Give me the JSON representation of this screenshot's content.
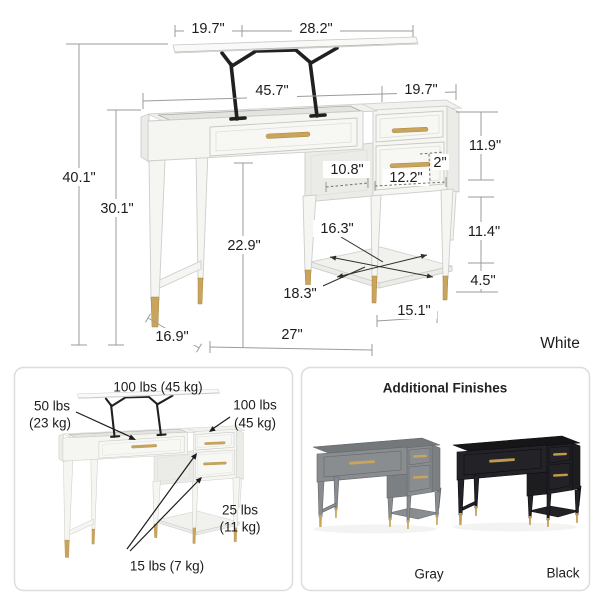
{
  "diagram": {
    "finish_label": "White",
    "dims": {
      "lift_left": "19.7\"",
      "lift_right": "28.2\"",
      "width_main": "45.7\"",
      "width_side": "19.7\"",
      "height_total": "40.1\"",
      "height_desk": "30.1\"",
      "clearance": "22.9\"",
      "drawer_section_height": "11.9\"",
      "side_opening_depth": "10.8\"",
      "drawer_face": "2\"",
      "side_opening_width": "12.2\"",
      "shelf_depth": "16.3\"",
      "leg_height": "11.4\"",
      "foot_height": "4.5\"",
      "shelf_width": "18.3\"",
      "desk_depth": "16.9\"",
      "kneehole_width": "27\"",
      "side_base_width": "15.1\""
    }
  },
  "weights": {
    "top_total": "100 lbs (45 kg)",
    "lift_line1": "50 lbs",
    "lift_line2": "(23 kg)",
    "side_line1": "100 lbs",
    "side_line2": "(45 kg)",
    "shelf_line1": "25 lbs",
    "shelf_line2": "(11 kg)",
    "drawers": "15 lbs (7 kg)"
  },
  "finishes": {
    "title": "Additional Finishes",
    "options": [
      {
        "name": "Gray"
      },
      {
        "name": "Black"
      }
    ]
  }
}
